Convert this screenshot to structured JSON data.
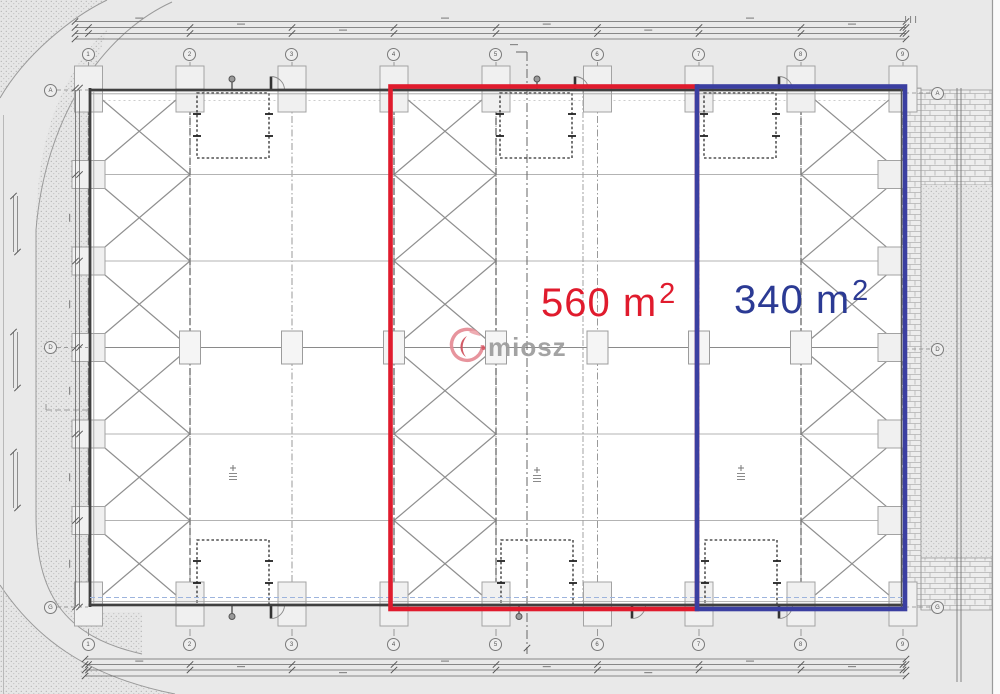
{
  "plan": {
    "watermark": {
      "text": "miosz"
    },
    "areas": [
      {
        "id": "red-zone",
        "text": "560 m",
        "sup": "2",
        "color": "#e01b2d"
      },
      {
        "id": "blue-zone",
        "text": "340 m",
        "sup": "2",
        "color": "#2b3a94"
      }
    ],
    "grid": {
      "top": [
        "1",
        "2",
        "3",
        "4",
        "5",
        "6",
        "7",
        "8",
        "9"
      ],
      "bottom": [
        "1",
        "2",
        "3",
        "4",
        "5",
        "6",
        "7",
        "8",
        "9"
      ],
      "left": [
        "A",
        "D",
        "G"
      ],
      "right": [
        "A",
        "D",
        "G"
      ]
    },
    "colors": {
      "red_outline": "#e01b2d",
      "blue_outline": "#3b3fa1",
      "watermark_text": "#9c9c9c",
      "logo_red": "#cf4f5b",
      "logo_pink": "#eda6ac"
    }
  }
}
